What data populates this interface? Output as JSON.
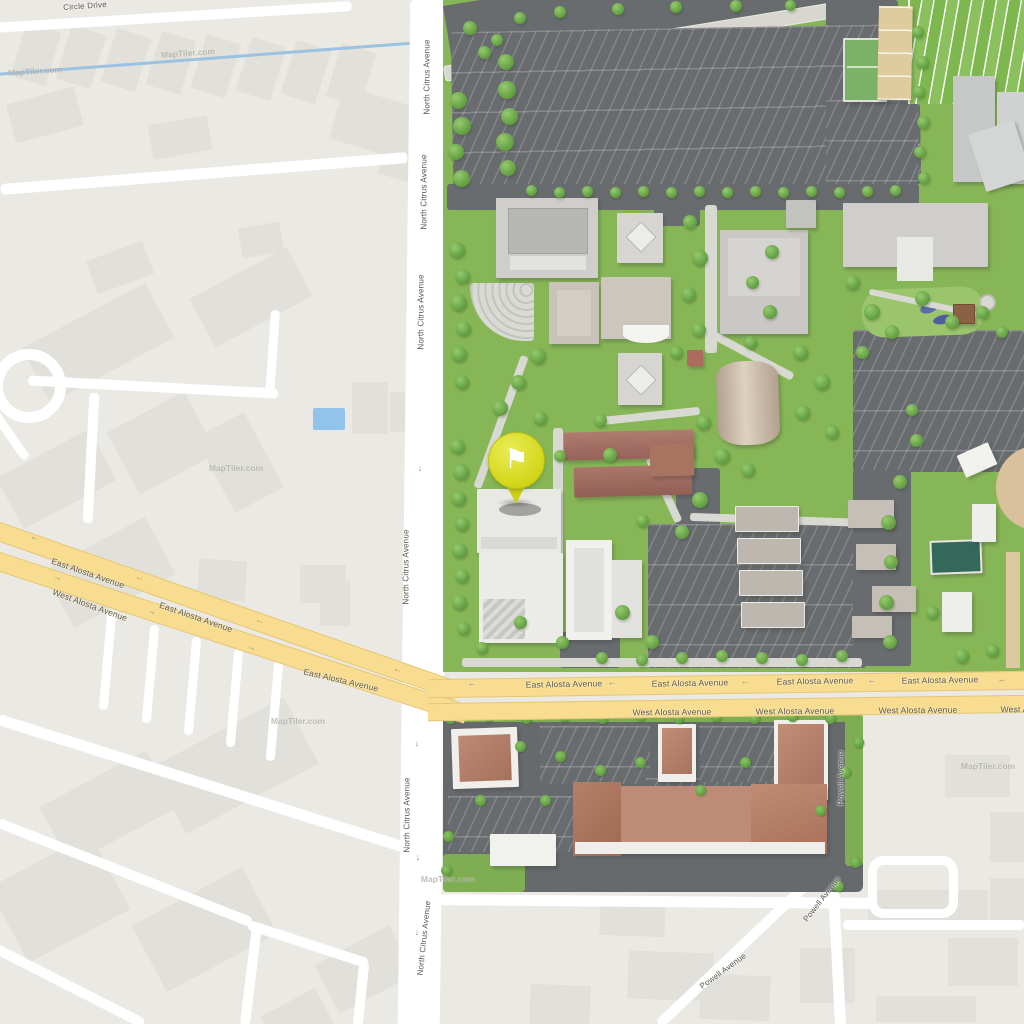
{
  "map_title": "Campus map with flag marker",
  "watermark": "MapTiler.com",
  "streets": {
    "circle_drive": "Circle Drive",
    "north_citrus_avenue": "North Citrus Avenue",
    "east_alosta_avenue": "East Alosta Avenue",
    "west_alosta_avenue": "West Alosta Avenue",
    "powell_avenue": "Powell Avenue"
  },
  "marker": {
    "icon": "flag-icon",
    "glyph": "⚑",
    "balloon_color": "#d3d71b",
    "flag_color": "#ffffff"
  },
  "icons": {
    "arrow_left": "←",
    "arrow_right": "→",
    "arrow_down": "↓"
  },
  "colors": {
    "highway_yellow": "#f8dd90",
    "campus_grass": "#87b657",
    "parking_asphalt": "#696c6f",
    "water_blue": "#9cc2e2",
    "building_light": "#e1e0da",
    "roof_terracotta": "#bd8b77",
    "sports_field_green": "#84bb55",
    "sand_court_tan": "#e0cb9e"
  }
}
